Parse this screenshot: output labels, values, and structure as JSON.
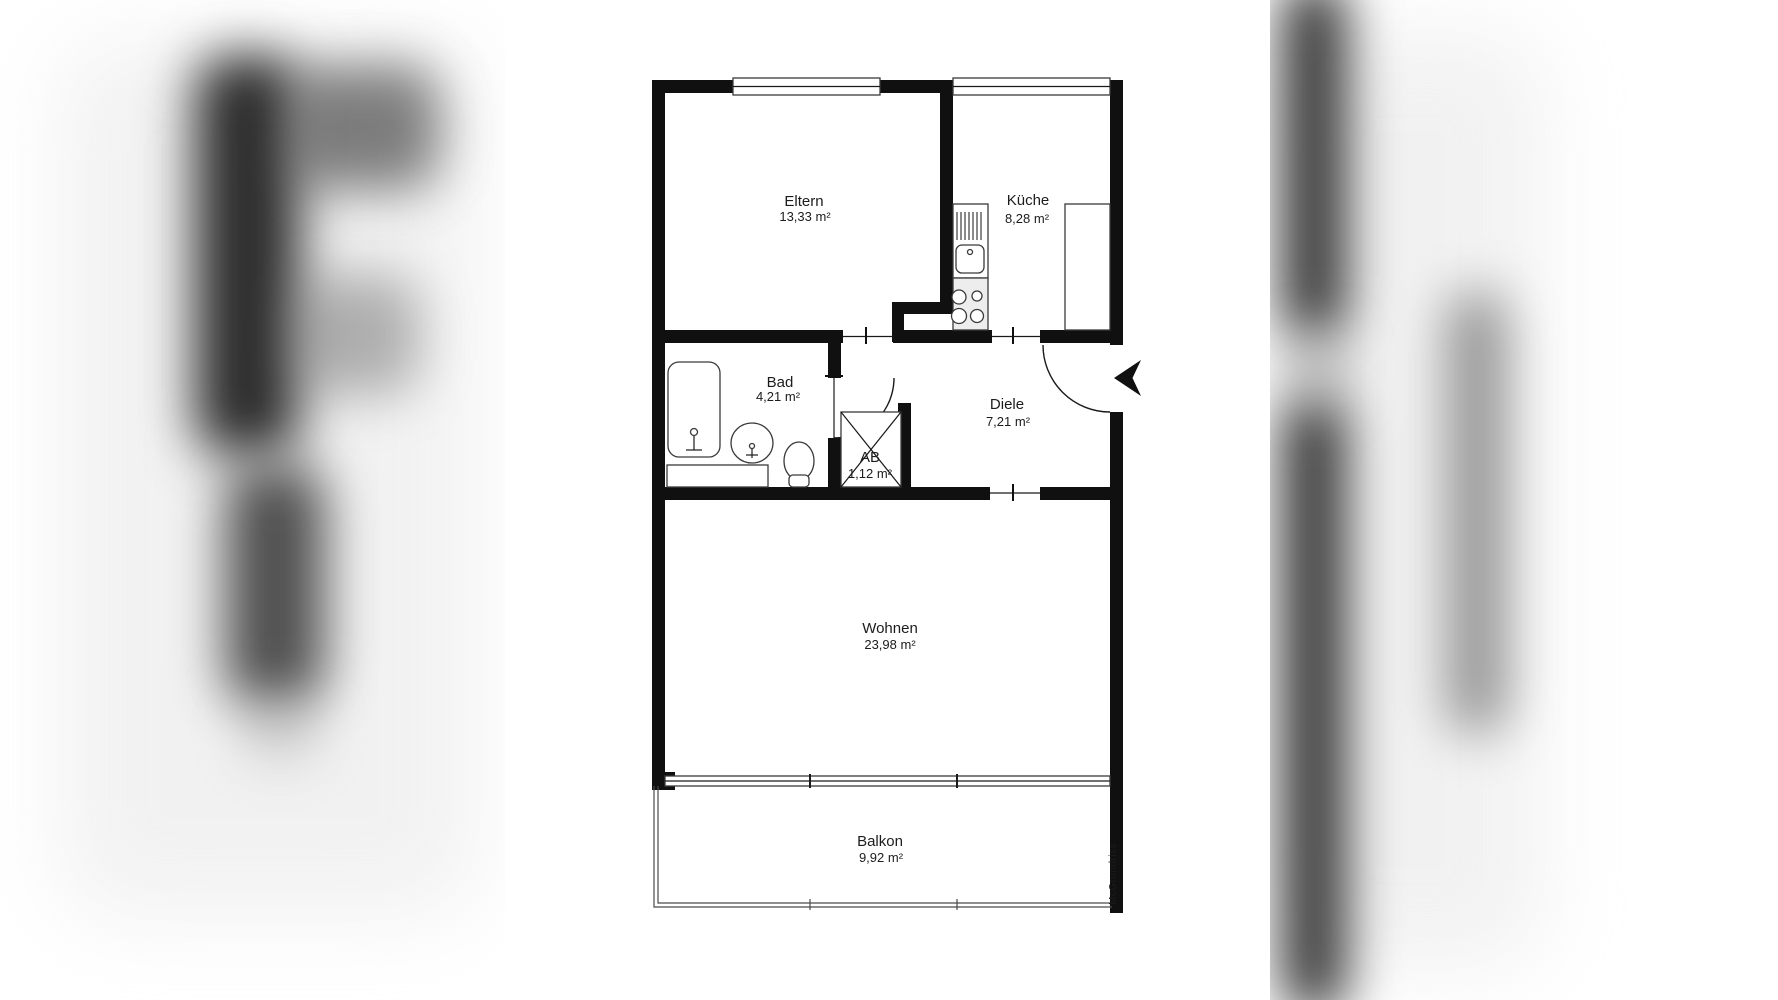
{
  "watermark": {
    "text": "McGrundriss"
  },
  "rooms": {
    "eltern": {
      "name": "Eltern",
      "area": "13,33 m²"
    },
    "kueche": {
      "name": "Küche",
      "area": "8,28 m²"
    },
    "bad": {
      "name": "Bad",
      "area": "4,21 m²"
    },
    "diele": {
      "name": "Diele",
      "area": "7,21 m²"
    },
    "ab": {
      "name": "AB",
      "area": "1,12 m²"
    },
    "wohnen": {
      "name": "Wohnen",
      "area": "23,98 m²"
    },
    "balkon": {
      "name": "Balkon",
      "area": "9,92 m²"
    }
  },
  "colors": {
    "wall": "#101010",
    "fixture_stroke": "#3a3a3a",
    "watermark_gray": "#a9a9a9",
    "background": "#ffffff"
  }
}
